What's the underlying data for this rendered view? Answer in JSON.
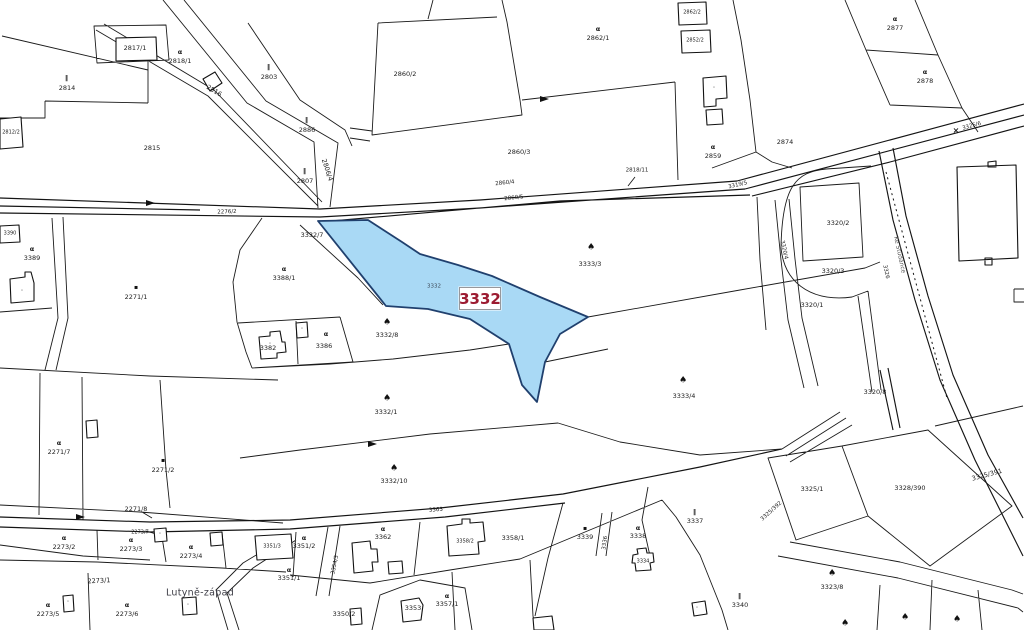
{
  "map": {
    "highlight": {
      "parcel": "3332",
      "fill": "#a9d9f5",
      "stroke": "#20406e",
      "label_color": "#9c1b31"
    },
    "place_name": "Lutyně-západ",
    "street_name": "Ke Studánce",
    "line_color": "#1b1b1b",
    "icon_glyphs": {
      "tree": "♠",
      "garden": "α",
      "meadow": "‖",
      "dotsq": "▪",
      "cross": "×",
      "pt": "·"
    },
    "labels": [
      {
        "t": "2817/1",
        "x": 135,
        "y": 48
      },
      {
        "t": "2814",
        "x": 67,
        "y": 88
      },
      {
        "t": "2815",
        "x": 152,
        "y": 148
      },
      {
        "t": "2812/2",
        "x": 11,
        "y": 133,
        "s": 5
      },
      {
        "t": "2818/1",
        "x": 180,
        "y": 61
      },
      {
        "t": "2803",
        "x": 269,
        "y": 77
      },
      {
        "t": "2886",
        "x": 307,
        "y": 130
      },
      {
        "t": "2807",
        "x": 305,
        "y": 181
      },
      {
        "t": "2816",
        "x": 214,
        "y": 91,
        "r": 31
      },
      {
        "t": "2806/4",
        "x": 327,
        "y": 170,
        "r": 72
      },
      {
        "t": "2276/2",
        "x": 227,
        "y": 213,
        "r": -2,
        "s": 5.5
      },
      {
        "t": "2860/2",
        "x": 405,
        "y": 74
      },
      {
        "t": "2860/3",
        "x": 519,
        "y": 152
      },
      {
        "t": "2862/1",
        "x": 598,
        "y": 38
      },
      {
        "t": "2862/2",
        "x": 692,
        "y": 13,
        "s": 5
      },
      {
        "t": "2852/2",
        "x": 695,
        "y": 41,
        "s": 5
      },
      {
        "t": "2860/4",
        "x": 505,
        "y": 184,
        "r": -6,
        "s": 5.5
      },
      {
        "t": "2860/5",
        "x": 514,
        "y": 199,
        "r": -6,
        "s": 5.5
      },
      {
        "t": "2818/11",
        "x": 637,
        "y": 171,
        "s": 5.5
      },
      {
        "t": "3319/5",
        "x": 738,
        "y": 186,
        "r": -13,
        "s": 5.5
      },
      {
        "t": "2874",
        "x": 785,
        "y": 142
      },
      {
        "t": "2877",
        "x": 895,
        "y": 28
      },
      {
        "t": "2878",
        "x": 925,
        "y": 81
      },
      {
        "t": "2859",
        "x": 713,
        "y": 156
      },
      {
        "t": "3325/6",
        "x": 972,
        "y": 127,
        "r": -15,
        "s": 5.5
      },
      {
        "t": "3390",
        "x": 10,
        "y": 234,
        "s": 5
      },
      {
        "t": "3389",
        "x": 32,
        "y": 258
      },
      {
        "t": "3388/1",
        "x": 284,
        "y": 278
      },
      {
        "t": "2271/1",
        "x": 136,
        "y": 297
      },
      {
        "t": "3332/7",
        "x": 312,
        "y": 235
      },
      {
        "t": "3382",
        "x": 268,
        "y": 348
      },
      {
        "t": "3386",
        "x": 324,
        "y": 346
      },
      {
        "t": "3332",
        "x": 434,
        "y": 287,
        "s": 5.5,
        "c": "muted"
      },
      {
        "t": "3333/3",
        "x": 590,
        "y": 264
      },
      {
        "t": "3333/4",
        "x": 684,
        "y": 396
      },
      {
        "t": "3332/8",
        "x": 387,
        "y": 335
      },
      {
        "t": "3332/1",
        "x": 386,
        "y": 412
      },
      {
        "t": "3332/10",
        "x": 394,
        "y": 481
      },
      {
        "t": "3320/2",
        "x": 838,
        "y": 223
      },
      {
        "t": "3320/3",
        "x": 833,
        "y": 271
      },
      {
        "t": "3320/1",
        "x": 812,
        "y": 305
      },
      {
        "t": "3320/4",
        "x": 783,
        "y": 250,
        "r": 78,
        "s": 5.5
      },
      {
        "t": "3326",
        "x": 885,
        "y": 272,
        "r": 78,
        "s": 5.5
      },
      {
        "t": "3320/8",
        "x": 875,
        "y": 392
      },
      {
        "t": "2271/7",
        "x": 59,
        "y": 452
      },
      {
        "t": "2271/2",
        "x": 163,
        "y": 470
      },
      {
        "t": "2271/8",
        "x": 136,
        "y": 509
      },
      {
        "t": "2273/2",
        "x": 64,
        "y": 547
      },
      {
        "t": "2273/3",
        "x": 131,
        "y": 549
      },
      {
        "t": "2273/4",
        "x": 191,
        "y": 556
      },
      {
        "t": "2273/7",
        "x": 140,
        "y": 533,
        "s": 5
      },
      {
        "t": "2273/1",
        "x": 99,
        "y": 581,
        "r": -3
      },
      {
        "t": "2273/5",
        "x": 48,
        "y": 614
      },
      {
        "t": "2273/6",
        "x": 127,
        "y": 614
      },
      {
        "t": "3351/3",
        "x": 272,
        "y": 547,
        "s": 5
      },
      {
        "t": "3351/2",
        "x": 304,
        "y": 546
      },
      {
        "t": "3362",
        "x": 383,
        "y": 537
      },
      {
        "t": "3351/1",
        "x": 289,
        "y": 578
      },
      {
        "t": "3354/3",
        "x": 336,
        "y": 565,
        "r": -78,
        "s": 5.5
      },
      {
        "t": "3358/2",
        "x": 465,
        "y": 542,
        "s": 5
      },
      {
        "t": "3358/1",
        "x": 513,
        "y": 538
      },
      {
        "t": "3363",
        "x": 436,
        "y": 511,
        "r": -4,
        "s": 5.5
      },
      {
        "t": "3350/2",
        "x": 344,
        "y": 614
      },
      {
        "t": "3353",
        "x": 413,
        "y": 608
      },
      {
        "t": "3357/1",
        "x": 447,
        "y": 604
      },
      {
        "t": "3336",
        "x": 606,
        "y": 543,
        "r": -82,
        "s": 5.5
      },
      {
        "t": "3339",
        "x": 585,
        "y": 537
      },
      {
        "t": "3338",
        "x": 638,
        "y": 536
      },
      {
        "t": "3337",
        "x": 695,
        "y": 521
      },
      {
        "t": "3334",
        "x": 643,
        "y": 562,
        "s": 5
      },
      {
        "t": "3340",
        "x": 740,
        "y": 605
      },
      {
        "t": "3325/1",
        "x": 812,
        "y": 489
      },
      {
        "t": "3325/392",
        "x": 772,
        "y": 512,
        "r": -42,
        "s": 5.5
      },
      {
        "t": "3328/390",
        "x": 910,
        "y": 488
      },
      {
        "t": "3325/391",
        "x": 987,
        "y": 475,
        "r": -15
      },
      {
        "t": "3323/8",
        "x": 832,
        "y": 587
      }
    ],
    "symbols": [
      {
        "k": "garden",
        "x": 180,
        "y": 52
      },
      {
        "k": "garden",
        "x": 598,
        "y": 29
      },
      {
        "k": "garden",
        "x": 895,
        "y": 19
      },
      {
        "k": "garden",
        "x": 925,
        "y": 72
      },
      {
        "k": "garden",
        "x": 713,
        "y": 147
      },
      {
        "k": "garden",
        "x": 284,
        "y": 269
      },
      {
        "k": "garden",
        "x": 326,
        "y": 334
      },
      {
        "k": "garden",
        "x": 32,
        "y": 249
      },
      {
        "k": "garden",
        "x": 59,
        "y": 443
      },
      {
        "k": "garden",
        "x": 64,
        "y": 538
      },
      {
        "k": "garden",
        "x": 131,
        "y": 540
      },
      {
        "k": "garden",
        "x": 191,
        "y": 547
      },
      {
        "k": "garden",
        "x": 48,
        "y": 605
      },
      {
        "k": "garden",
        "x": 127,
        "y": 605
      },
      {
        "k": "garden",
        "x": 304,
        "y": 538
      },
      {
        "k": "garden",
        "x": 383,
        "y": 529
      },
      {
        "k": "garden",
        "x": 289,
        "y": 570
      },
      {
        "k": "garden",
        "x": 638,
        "y": 528
      },
      {
        "k": "garden",
        "x": 447,
        "y": 596
      },
      {
        "k": "tree",
        "x": 591,
        "y": 248
      },
      {
        "k": "tree",
        "x": 683,
        "y": 381
      },
      {
        "k": "tree",
        "x": 387,
        "y": 323
      },
      {
        "k": "tree",
        "x": 387,
        "y": 399
      },
      {
        "k": "tree",
        "x": 394,
        "y": 469
      },
      {
        "k": "tree",
        "x": 832,
        "y": 574
      },
      {
        "k": "tree",
        "x": 845,
        "y": 624
      },
      {
        "k": "tree",
        "x": 905,
        "y": 618
      },
      {
        "k": "tree",
        "x": 957,
        "y": 620
      },
      {
        "k": "meadow",
        "x": 67,
        "y": 79
      },
      {
        "k": "meadow",
        "x": 269,
        "y": 68
      },
      {
        "k": "meadow",
        "x": 307,
        "y": 121
      },
      {
        "k": "meadow",
        "x": 305,
        "y": 172
      },
      {
        "k": "meadow",
        "x": 695,
        "y": 513
      },
      {
        "k": "meadow",
        "x": 740,
        "y": 597
      },
      {
        "k": "dotsq",
        "x": 136,
        "y": 288
      },
      {
        "k": "dotsq",
        "x": 163,
        "y": 461
      },
      {
        "k": "dotsq",
        "x": 585,
        "y": 529
      },
      {
        "k": "cross",
        "x": 956,
        "y": 131
      },
      {
        "k": "pt",
        "x": 270,
        "y": 344
      },
      {
        "k": "pt",
        "x": 22,
        "y": 291
      },
      {
        "k": "pt",
        "x": 714,
        "y": 88
      },
      {
        "k": "pt",
        "x": 302,
        "y": 329
      },
      {
        "k": "pt",
        "x": 160,
        "y": 534
      },
      {
        "k": "pt",
        "x": 68,
        "y": 602
      },
      {
        "k": "pt",
        "x": 188,
        "y": 605
      },
      {
        "k": "pt",
        "x": 697,
        "y": 608
      }
    ]
  }
}
